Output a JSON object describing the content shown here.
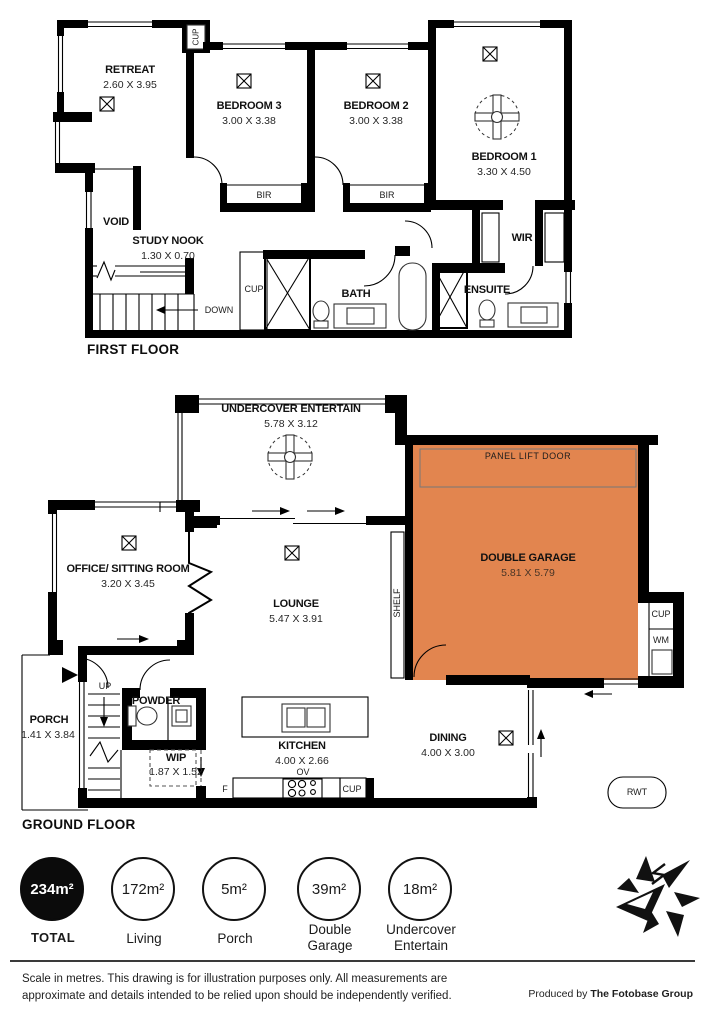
{
  "floors": {
    "first": {
      "title": "FIRST FLOOR",
      "rooms": {
        "retreat": {
          "name": "RETREAT",
          "dims": "2.60 X 3.95"
        },
        "bedroom3": {
          "name": "BEDROOM 3",
          "dims": "3.00 X 3.38"
        },
        "bedroom2": {
          "name": "BEDROOM 2",
          "dims": "3.00 X 3.38"
        },
        "bedroom1": {
          "name": "BEDROOM 1",
          "dims": "3.30 X 4.50"
        },
        "void": {
          "name": "VOID"
        },
        "study_nook": {
          "name": "STUDY NOOK",
          "dims": "1.30 X 0.70"
        },
        "bath": {
          "name": "BATH"
        },
        "ensuite": {
          "name": "ENSUITE"
        },
        "wir": {
          "name": "WIR"
        }
      },
      "annotations": {
        "cup_top": "CUP",
        "cup_hall": "CUP",
        "bir_bed3": "BIR",
        "bir_bed2": "BIR",
        "down": "DOWN"
      }
    },
    "ground": {
      "title": "GROUND FLOOR",
      "rooms": {
        "undercover_entertain": {
          "name": "UNDERCOVER ENTERTAIN",
          "dims": "5.78 X 3.12"
        },
        "double_garage": {
          "name": "DOUBLE GARAGE",
          "dims": "5.81 X 5.79"
        },
        "office": {
          "name": "OFFICE/ SITTING ROOM",
          "dims": "3.20 X 3.45"
        },
        "lounge": {
          "name": "LOUNGE",
          "dims": "5.47 X 3.91"
        },
        "porch": {
          "name": "PORCH",
          "dims": "1.41 X 3.84"
        },
        "powder": {
          "name": "POWDER"
        },
        "wip": {
          "name": "WIP",
          "dims": "1.87 X 1.52"
        },
        "kitchen": {
          "name": "KITCHEN",
          "dims": "4.00 X 2.66"
        },
        "dining": {
          "name": "DINING",
          "dims": "4.00 X 3.00"
        }
      },
      "annotations": {
        "panel_lift_door": "PANEL LIFT DOOR",
        "shelf": "SHELF",
        "up": "UP",
        "cup_garage": "CUP",
        "wm": "WM",
        "cup_kitchen": "CUP",
        "ov": "OV",
        "fridge": "F",
        "rwt": "RWT"
      }
    }
  },
  "summary": [
    {
      "value": "234m²",
      "label": "TOTAL",
      "filled": true
    },
    {
      "value": "172m²",
      "label": "Living",
      "filled": false
    },
    {
      "value": "5m²",
      "label": "Porch",
      "filled": false
    },
    {
      "value": "39m²",
      "label": "Double Garage",
      "filled": false
    },
    {
      "value": "18m²",
      "label": "Undercover Entertain",
      "filled": false
    }
  ],
  "footer": {
    "disclaimer_line1": "Scale in metres. This drawing is for illustration purposes only. All measurements are",
    "disclaimer_line2": "approximate and details intended to be relied upon should be independently verified.",
    "produced_by_prefix": "Produced by",
    "produced_by_brand": "The Fotobase Group"
  },
  "colors": {
    "garage_fill": "#E2854F",
    "wall": "#000000"
  },
  "icons": {
    "logo": "compass-north-star",
    "fan": "ceiling-fan",
    "vent": "crossed-box-downlight"
  }
}
